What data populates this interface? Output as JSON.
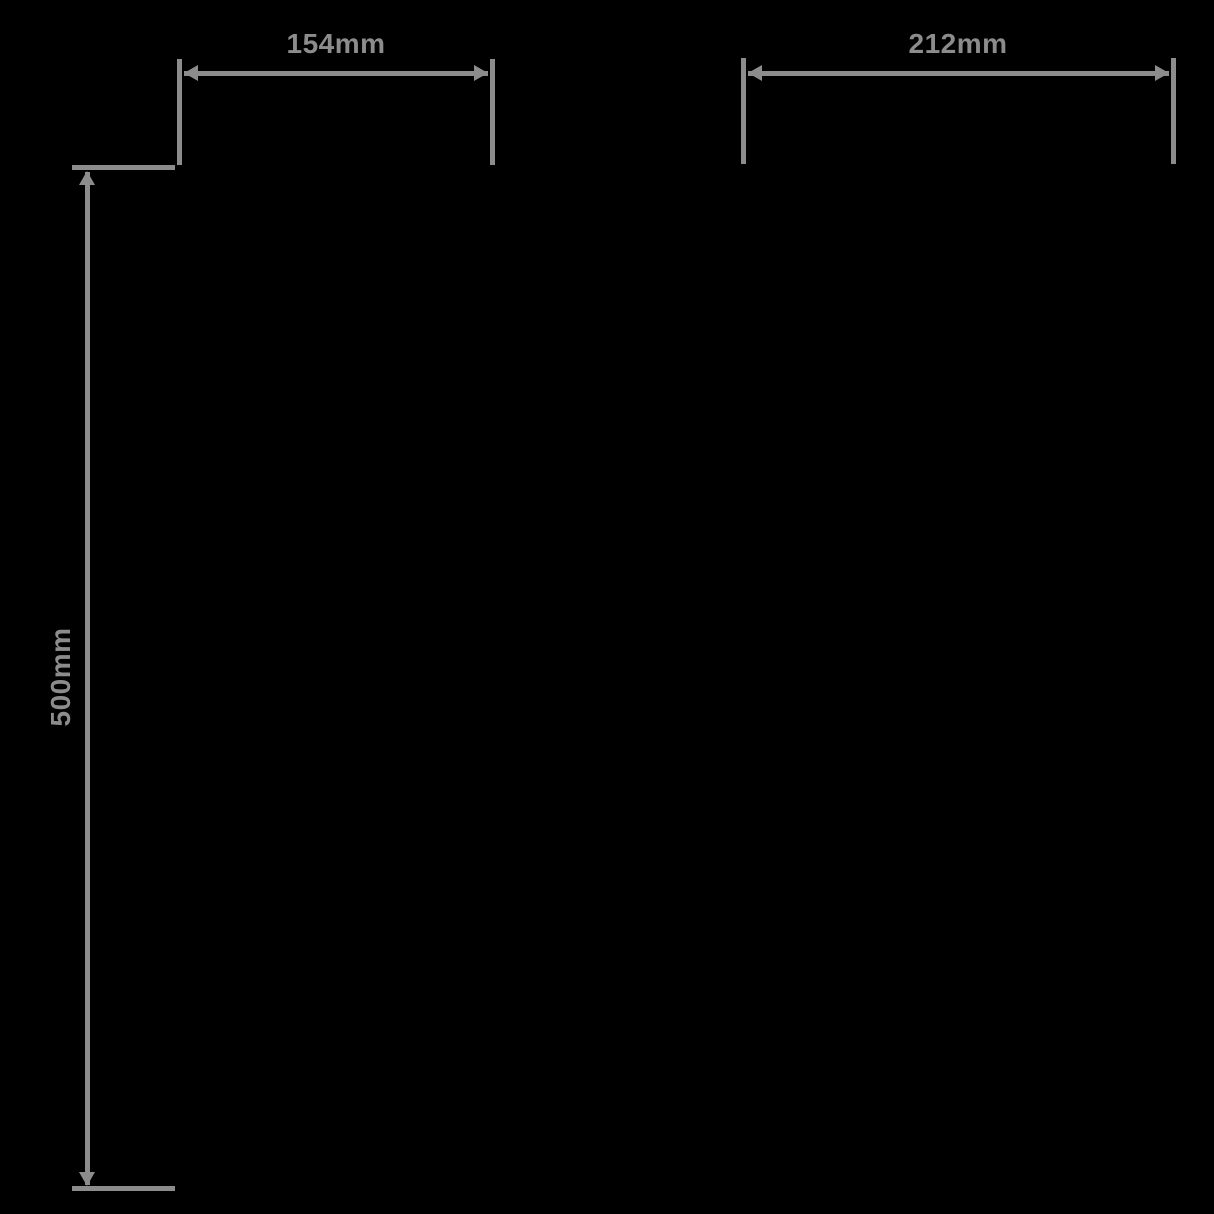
{
  "diagram": {
    "type": "product-dimension-diagram",
    "colors": {
      "background": "#000000",
      "line": "#8c8c8c"
    },
    "dimensions": [
      {
        "id": "top-left-width",
        "label": "154mm",
        "orientation": "horizontal"
      },
      {
        "id": "top-right-width",
        "label": "212mm",
        "orientation": "horizontal"
      },
      {
        "id": "left-height",
        "label": "500mm",
        "orientation": "vertical"
      }
    ]
  }
}
